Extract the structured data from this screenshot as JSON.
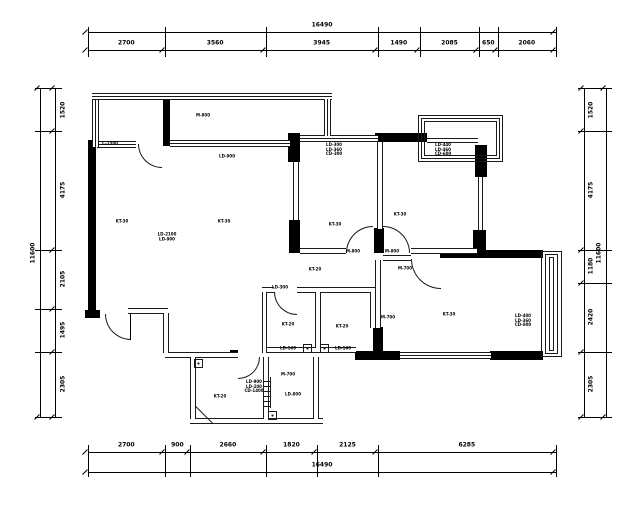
{
  "page": {
    "background": "#ffffff"
  },
  "colors": {
    "wall": "#000000",
    "line": "#1a1a1a",
    "text": "#000000"
  },
  "dimensions": {
    "top": {
      "total": "16490",
      "segments": [
        "2700",
        "3560",
        "3945",
        "1490",
        "2085",
        "650",
        "2060"
      ]
    },
    "bottom": {
      "total": "16490",
      "segments": [
        "2700",
        "900",
        "2660",
        "1820",
        "2125",
        "6285"
      ]
    },
    "left": {
      "total": "11600",
      "segments": [
        "1520",
        "4175",
        "2105",
        "1495",
        "2305"
      ]
    },
    "right": {
      "total": "11600",
      "segments": [
        "1520",
        "4175",
        "1180",
        "2420",
        "2305"
      ]
    }
  },
  "room_labels": [
    {
      "x": 203,
      "y": 116,
      "text": "M-800"
    },
    {
      "x": 110,
      "y": 144,
      "text": "C-1500"
    },
    {
      "x": 227,
      "y": 157,
      "text": "LD-900"
    },
    {
      "x": 122,
      "y": 222,
      "text": "KT-30"
    },
    {
      "x": 224,
      "y": 222,
      "text": "KT-30"
    },
    {
      "x": 167,
      "y": 237,
      "text": "LD-2100\nLD-900"
    },
    {
      "x": 334,
      "y": 150,
      "text": "LD-300\nLD-360\nCD-300"
    },
    {
      "x": 443,
      "y": 150,
      "text": "LD-440\nLD-460\nCD-600"
    },
    {
      "x": 335,
      "y": 225,
      "text": "KT-30"
    },
    {
      "x": 400,
      "y": 215,
      "text": "KT-30"
    },
    {
      "x": 353,
      "y": 252,
      "text": "M-800"
    },
    {
      "x": 392,
      "y": 252,
      "text": "M-800"
    },
    {
      "x": 280,
      "y": 288,
      "text": "LD-300"
    },
    {
      "x": 315,
      "y": 270,
      "text": "KT-20"
    },
    {
      "x": 405,
      "y": 269,
      "text": "M-700"
    },
    {
      "x": 388,
      "y": 318,
      "text": "M-700"
    },
    {
      "x": 288,
      "y": 325,
      "text": "KT-20"
    },
    {
      "x": 342,
      "y": 327,
      "text": "KT-20"
    },
    {
      "x": 449,
      "y": 315,
      "text": "KT-30"
    },
    {
      "x": 523,
      "y": 321,
      "text": "LD-400\nLD-360\nCD-800"
    },
    {
      "x": 288,
      "y": 349,
      "text": "LD-140"
    },
    {
      "x": 343,
      "y": 349,
      "text": "LD-140"
    },
    {
      "x": 288,
      "y": 375,
      "text": "M-700"
    },
    {
      "x": 254,
      "y": 387,
      "text": "LD-900\nLD-200\nCD-1400"
    },
    {
      "x": 220,
      "y": 397,
      "text": "KT-20"
    },
    {
      "x": 293,
      "y": 395,
      "text": "LD-800"
    }
  ]
}
